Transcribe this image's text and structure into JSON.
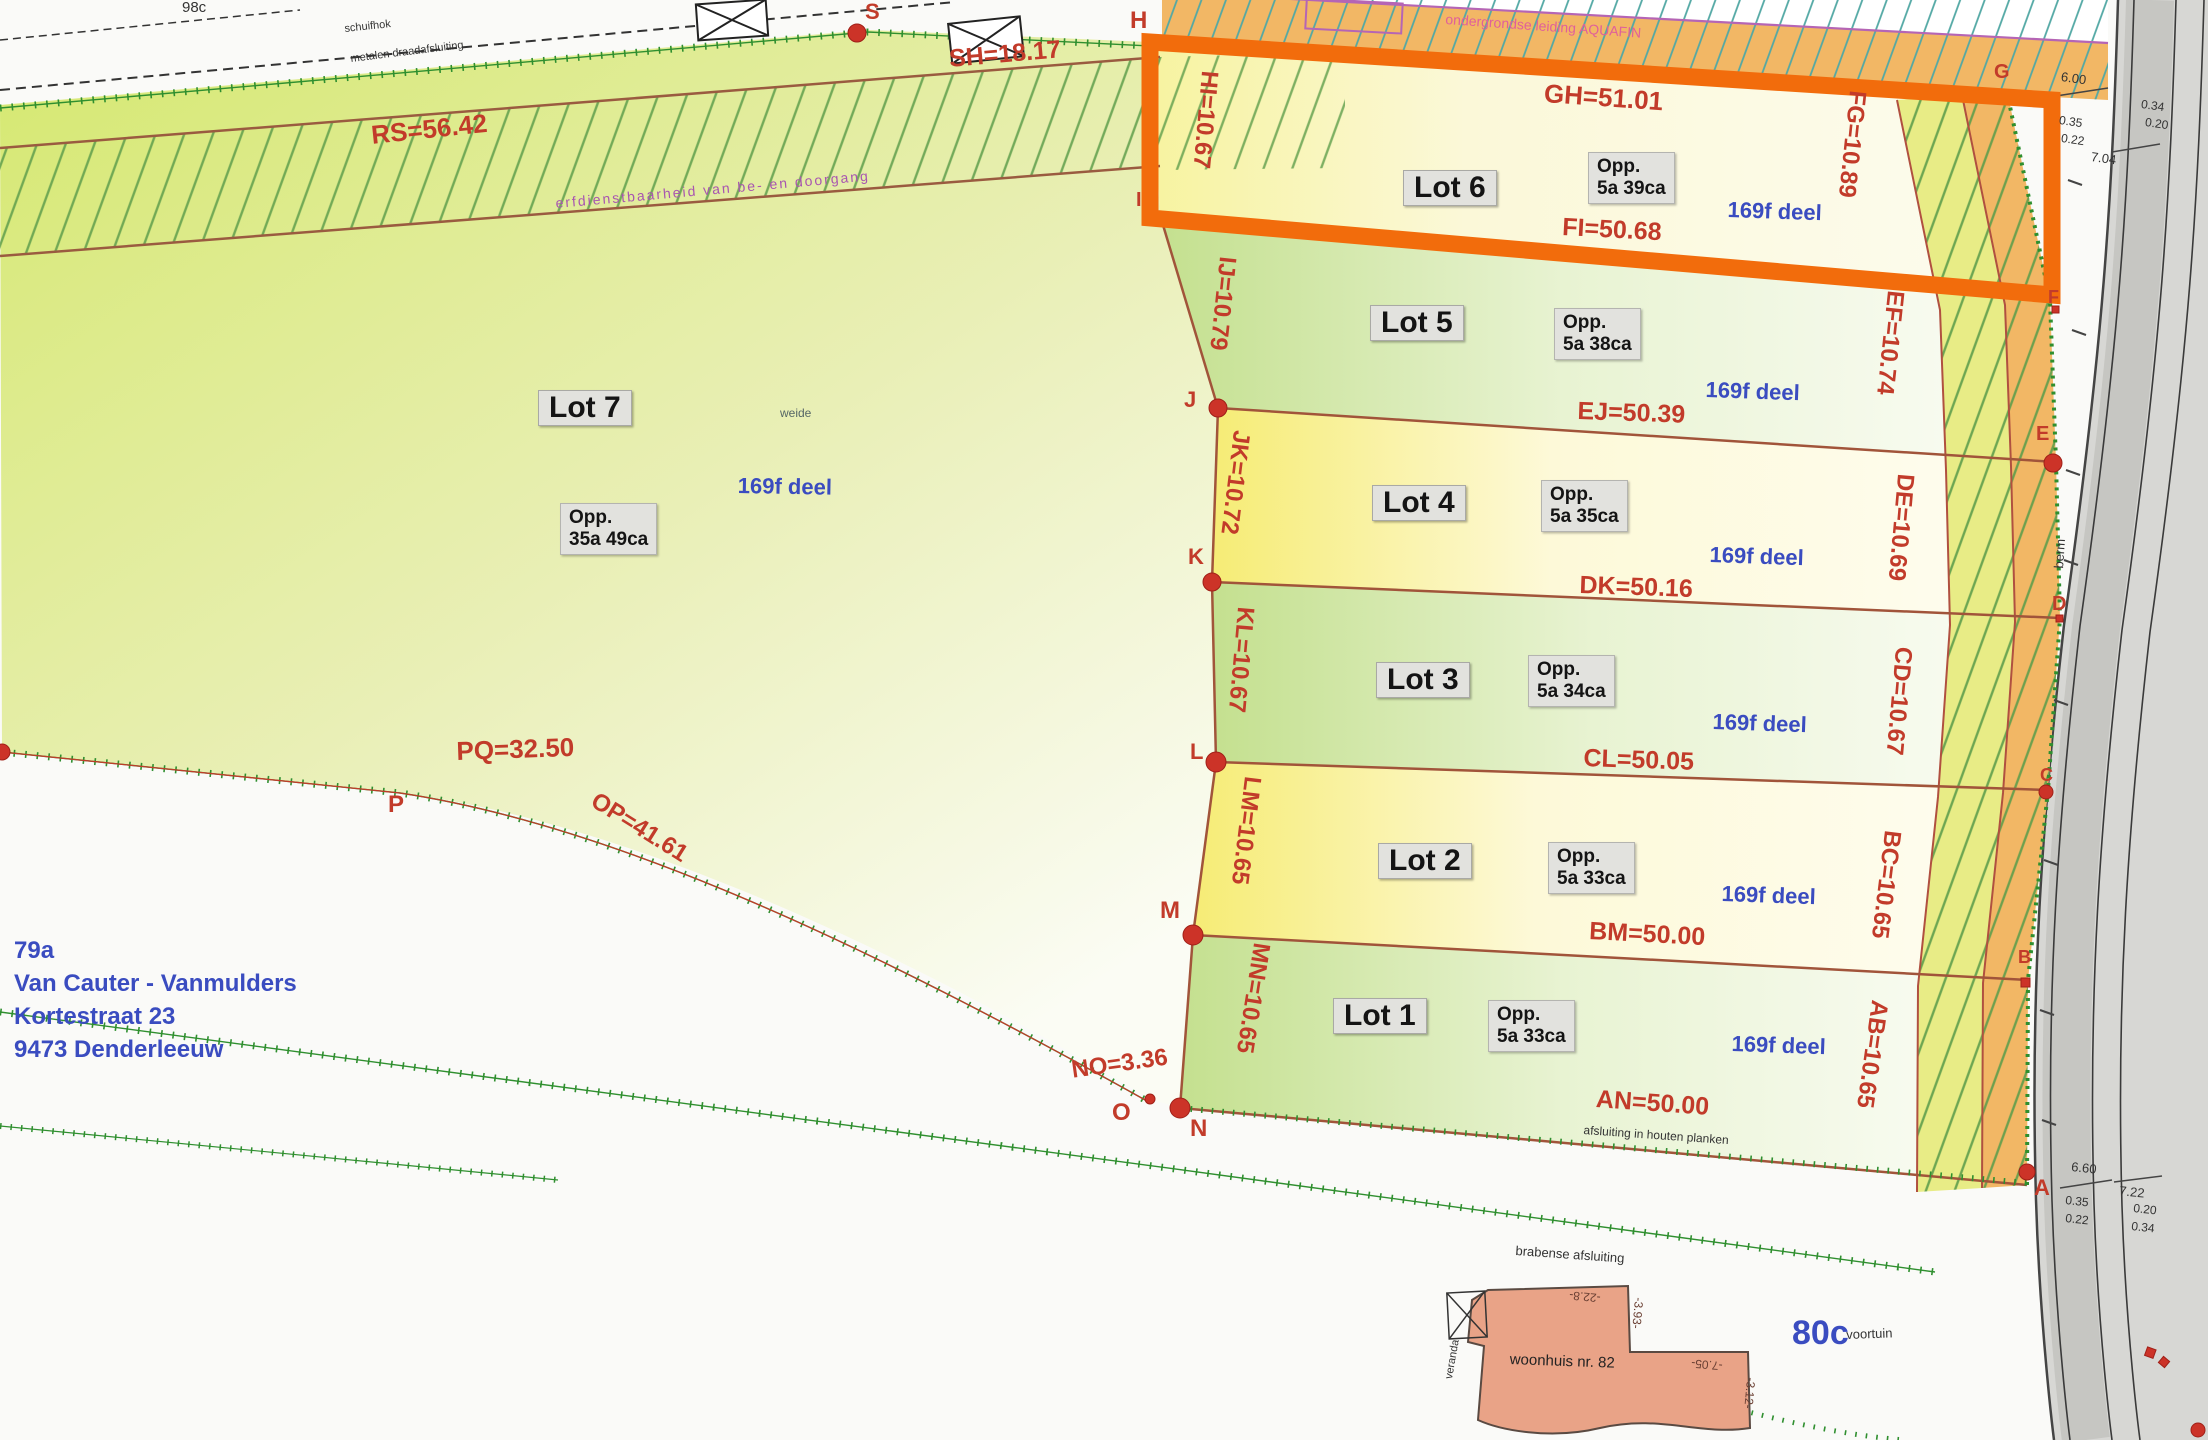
{
  "owner": {
    "parcel": "79a",
    "name": "Van Cauter - Vanmulders",
    "street": "Kortestraat 23",
    "city": "9473 Denderleeuw"
  },
  "lots": {
    "lot7": {
      "label": "Lot 7",
      "opp_title": "Opp.",
      "opp_value": "35a 49ca",
      "deel": "169f deel",
      "landuse": "weide"
    },
    "lot6": {
      "label": "Lot 6",
      "opp_title": "Opp.",
      "opp_value": "5a 39ca",
      "deel": "169f deel",
      "length": "FI=50.68"
    },
    "lot5": {
      "label": "Lot 5",
      "opp_title": "Opp.",
      "opp_value": "5a 38ca",
      "deel": "169f deel",
      "length": "EJ=50.39"
    },
    "lot4": {
      "label": "Lot 4",
      "opp_title": "Opp.",
      "opp_value": "5a 35ca",
      "deel": "169f deel",
      "length": "DK=50.16"
    },
    "lot3": {
      "label": "Lot 3",
      "opp_title": "Opp.",
      "opp_value": "5a 34ca",
      "deel": "169f deel",
      "length": "CL=50.05"
    },
    "lot2": {
      "label": "Lot 2",
      "opp_title": "Opp.",
      "opp_value": "5a 33ca",
      "deel": "169f deel",
      "length": "BM=50.00"
    },
    "lot1": {
      "label": "Lot 1",
      "opp_title": "Opp.",
      "opp_value": "5a 33ca",
      "deel": "169f deel",
      "length": "AN=50.00"
    }
  },
  "measurements": {
    "rs": "RS=56.42",
    "sh": "SH=18.17",
    "gh": "GH=51.01",
    "qr": "QR=34.25",
    "pq": "PQ=32.50",
    "op": "OP=41.61",
    "no": "NO=3.36",
    "hi": "HI=10.67",
    "ij": "IJ=10.79",
    "jk": "JK=10.72",
    "kl": "KL=10.67",
    "lm": "LM=10.65",
    "mn": "MN=10.65",
    "fg": "FG=10.89",
    "ef": "EF=10.74",
    "de": "DE=10.69",
    "cd": "CD=10.67",
    "bc": "BC=10.65",
    "ab": "AB=10.65"
  },
  "points": {
    "a": "A",
    "b": "B",
    "c": "C",
    "d": "D",
    "e": "E",
    "f": "F",
    "g": "G",
    "h": "H",
    "i": "I",
    "j": "J",
    "k": "K",
    "l": "L",
    "m": "M",
    "n": "N",
    "o": "O",
    "p": "P",
    "s": "S"
  },
  "road_dimensions": {
    "top": [
      "6.00",
      "0.35",
      "0.22",
      "7.04",
      "0.34",
      "0.20"
    ],
    "bottom": [
      "6.60",
      "0.35",
      "0.22",
      "7.22",
      "0.20",
      "0.34"
    ]
  },
  "house": {
    "label": "woonhuis nr. 82",
    "parcel": "80c",
    "veranda": "veranda",
    "dims": [
      "-22.8-",
      "-3.93-",
      "-7.05-",
      "-3.12-"
    ]
  },
  "annotations": {
    "parcel_top": "98c",
    "shed": "schuifhok",
    "fence_top": "metalen draadafsluiting",
    "servitude": "erfdienstbaarheid van be- en doorgang",
    "pipeline": "ondergrondse leiding AQUAFIN",
    "fence_an": "afsluiting in houten planken",
    "fence_bottom": "brabense afsluiting",
    "berm": "berm",
    "front_garden": "voortuin"
  },
  "colors": {
    "highlight_orange": "#f26c0c",
    "measurement_red": "#c23b2a",
    "label_blue": "#3a4cc0",
    "strip_orange": "#f2b765",
    "parcel_green": "#d5e86f",
    "fence_green": "#2f8f2f"
  }
}
